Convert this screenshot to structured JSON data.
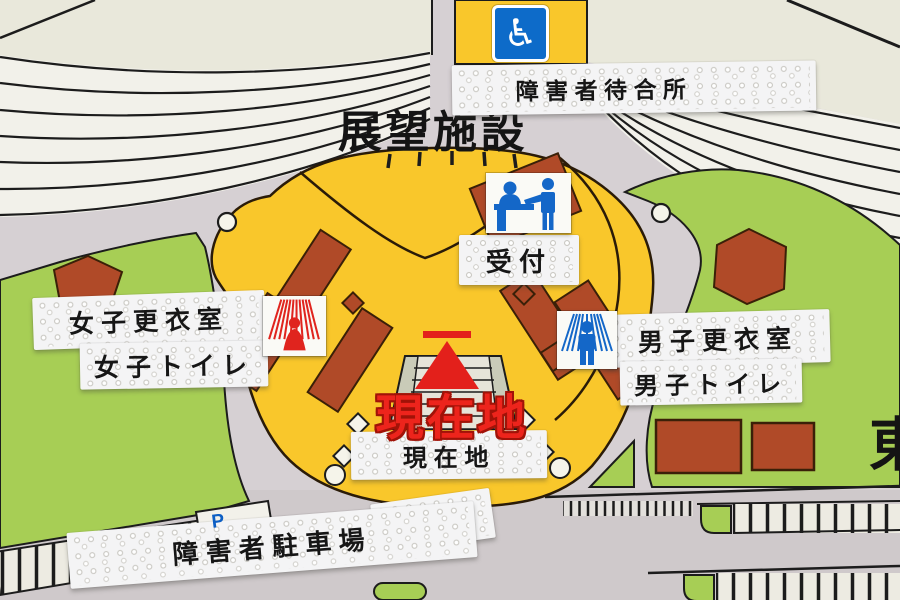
{
  "map": {
    "title": "展望施設",
    "marker": {
      "text": "現在地"
    },
    "edge_label_east": "東",
    "labels": {
      "waiting_area": "障害者待合所",
      "reception": "受付",
      "womens_changing_room": "女子更衣室",
      "womens_toilet": "女子トイレ",
      "mens_changing_room": "男子更衣室",
      "mens_toilet": "男子トイレ",
      "current_location": "現在地",
      "accessible_parking": "障害者駐車場"
    },
    "icons": {
      "wheelchair_symbol": "♿",
      "parking_letter": "P"
    },
    "colors": {
      "background_cream": "#E9E8DB",
      "road_gray": "#D6D0D3",
      "plaza_yellow": "#F9C72B",
      "grass_green": "#A7CE55",
      "building_brown": "#B04A28",
      "marker_red": "#E3201B",
      "icon_blue": "#1467C8",
      "label_white": "#F4F4F5"
    }
  }
}
